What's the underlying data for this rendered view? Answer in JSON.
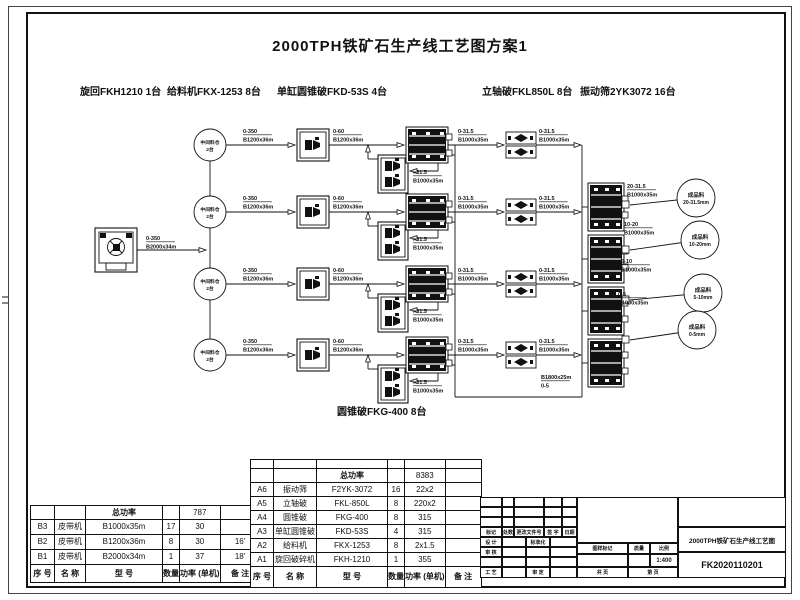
{
  "page": {
    "title": "2000TPH铁矿石生产线工艺图方案1"
  },
  "equipment_labels": [
    "旋回FKH1210 1台",
    "给料机FKX-1253 8台",
    "单缸圆锥破FKD-53S 4台",
    "立轴破FKL850L 8台",
    "振动筛2YK3072 16台"
  ],
  "diagram": {
    "bin": {
      "line1": "中间料仓",
      "line2": "2台"
    },
    "feed": {
      "top": "0-350",
      "bottom": "B2000x34m"
    },
    "bin_out": {
      "top": "0-350",
      "bottom": "B1200x36m"
    },
    "crusher_out": {
      "top": "0-60",
      "bottom": "B1200x36m"
    },
    "oversize": {
      "top": ">31.5",
      "bottom": "B1000x35m"
    },
    "screen_out": {
      "top": "0-31.5",
      "bottom": "B1000x35m"
    },
    "vsi_out": {
      "top": "0-31.5",
      "bottom": "B1000x35m"
    },
    "fines": {
      "top": "B1800x25m",
      "bottom": "0-5"
    },
    "products": [
      {
        "size": "20-31.5",
        "belt": "B1000x35m",
        "name": "成品料",
        "spec": "20-31.5mm"
      },
      {
        "size": "10-20",
        "belt": "B1000x35m",
        "name": "成品料",
        "spec": "10-20mm"
      },
      {
        "size": "5-10",
        "belt": "B1000x35m",
        "name": "成品料",
        "spec": "5-10mm"
      },
      {
        "size": "0-5",
        "belt": "B1000x35m",
        "name": "成品料",
        "spec": "0-5mm"
      }
    ],
    "cone_label": "圆锥破FKG-400 8台"
  },
  "belt_table": {
    "power_label": "总功率",
    "power_value": "787",
    "rows": [
      [
        "B3",
        "皮带机",
        "B1000x35m",
        "17",
        "30",
        ""
      ],
      [
        "B2",
        "皮带机",
        "B1200x36m",
        "8",
        "30",
        "16'"
      ],
      [
        "B1",
        "皮带机",
        "B2000x34m",
        "1",
        "37",
        "18'"
      ]
    ],
    "footer": [
      "序 号",
      "名  称",
      "型  号",
      "数量",
      "功率 (单机)",
      "备 注"
    ]
  },
  "equipment_table": {
    "power_label": "总功率",
    "power_value": "8383",
    "rows": [
      [
        "A6",
        "振动筛",
        "F2YK-3072",
        "16",
        "22x2",
        ""
      ],
      [
        "A5",
        "立轴破",
        "FKL-850L",
        "8",
        "220x2",
        ""
      ],
      [
        "A4",
        "圆锥破",
        "FKG-400",
        "8",
        "315",
        ""
      ],
      [
        "A3",
        "单缸圆锥破",
        "FKD-53S",
        "4",
        "315",
        ""
      ],
      [
        "A2",
        "给料机",
        "FKX-1253",
        "8",
        "2x1.5",
        ""
      ],
      [
        "A1",
        "旋回破碎机",
        "FKH-1210",
        "1",
        "355",
        ""
      ]
    ],
    "footer": [
      "序 号",
      "名  称",
      "型  号",
      "数量",
      "功率 (单机)",
      "备 注"
    ]
  },
  "title_block": {
    "revision_header": [
      "标记",
      "处数",
      "更改文件号",
      "签 字",
      "日期"
    ],
    "design": "设 计",
    "standardization": "标准化",
    "check": "审 核",
    "process": "工 艺",
    "approve": "审 定",
    "stamp_header": [
      "图样标记",
      "质量",
      "比例"
    ],
    "scale": "1:400",
    "total_pages": "共  页",
    "page_no": "第  页",
    "drawing_title": "2000TPH铁矿石生产线工艺图",
    "drawing_number": "FK2020110201"
  }
}
